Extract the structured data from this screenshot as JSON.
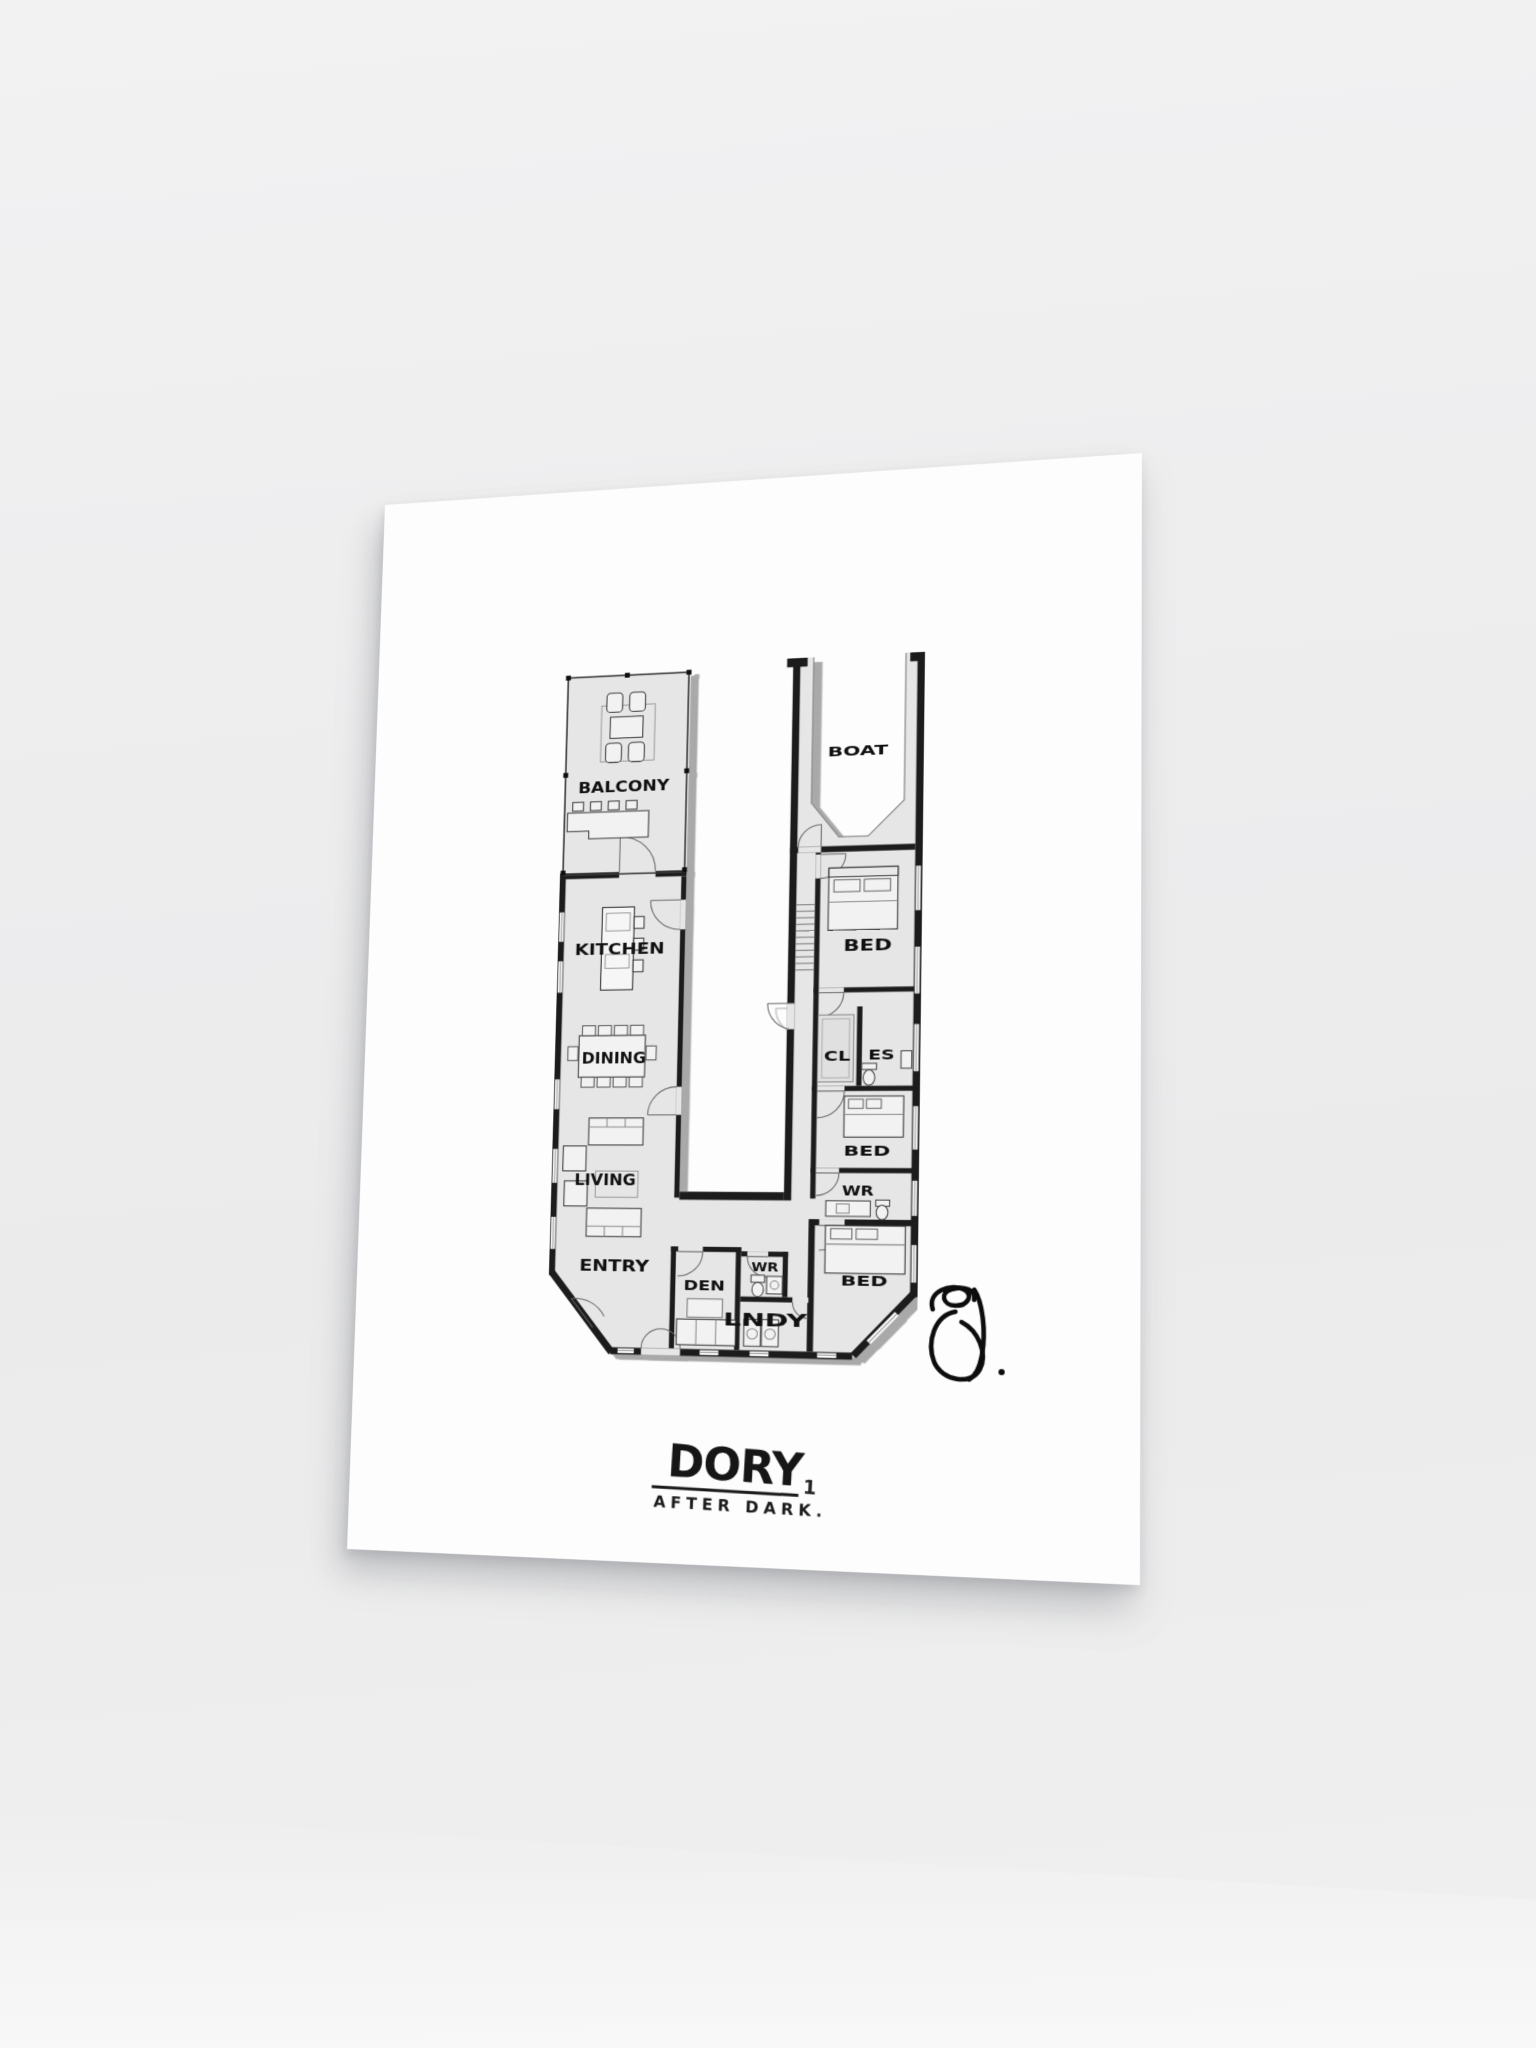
{
  "poster": {
    "brand": "DORY",
    "brand_mark": "1",
    "subtitle": "AFTER DARK.",
    "signature_icon": "signature-scribble-icon"
  },
  "floor_plan": {
    "rooms": {
      "balcony": "BALCONY",
      "boat": "BOAT",
      "kitchen": "KITCHEN",
      "dining": "DINING",
      "living": "LIVING",
      "entry": "ENTRY",
      "bed_upper": "BED",
      "closet": "CL",
      "ensuite": "ES",
      "bed_middle": "BED",
      "washroom_right": "WR",
      "bed_lower": "BED",
      "den": "DEN",
      "washroom_small": "WR",
      "laundry": "LNDY"
    }
  },
  "colors": {
    "background": "#efeff0",
    "poster": "#fdfdfd",
    "plan_floor": "#e6e6e6",
    "wall": "#1c1c1c",
    "plan_shadow": "#a9a9a9",
    "ink": "#111111",
    "thin_line": "#555555"
  }
}
